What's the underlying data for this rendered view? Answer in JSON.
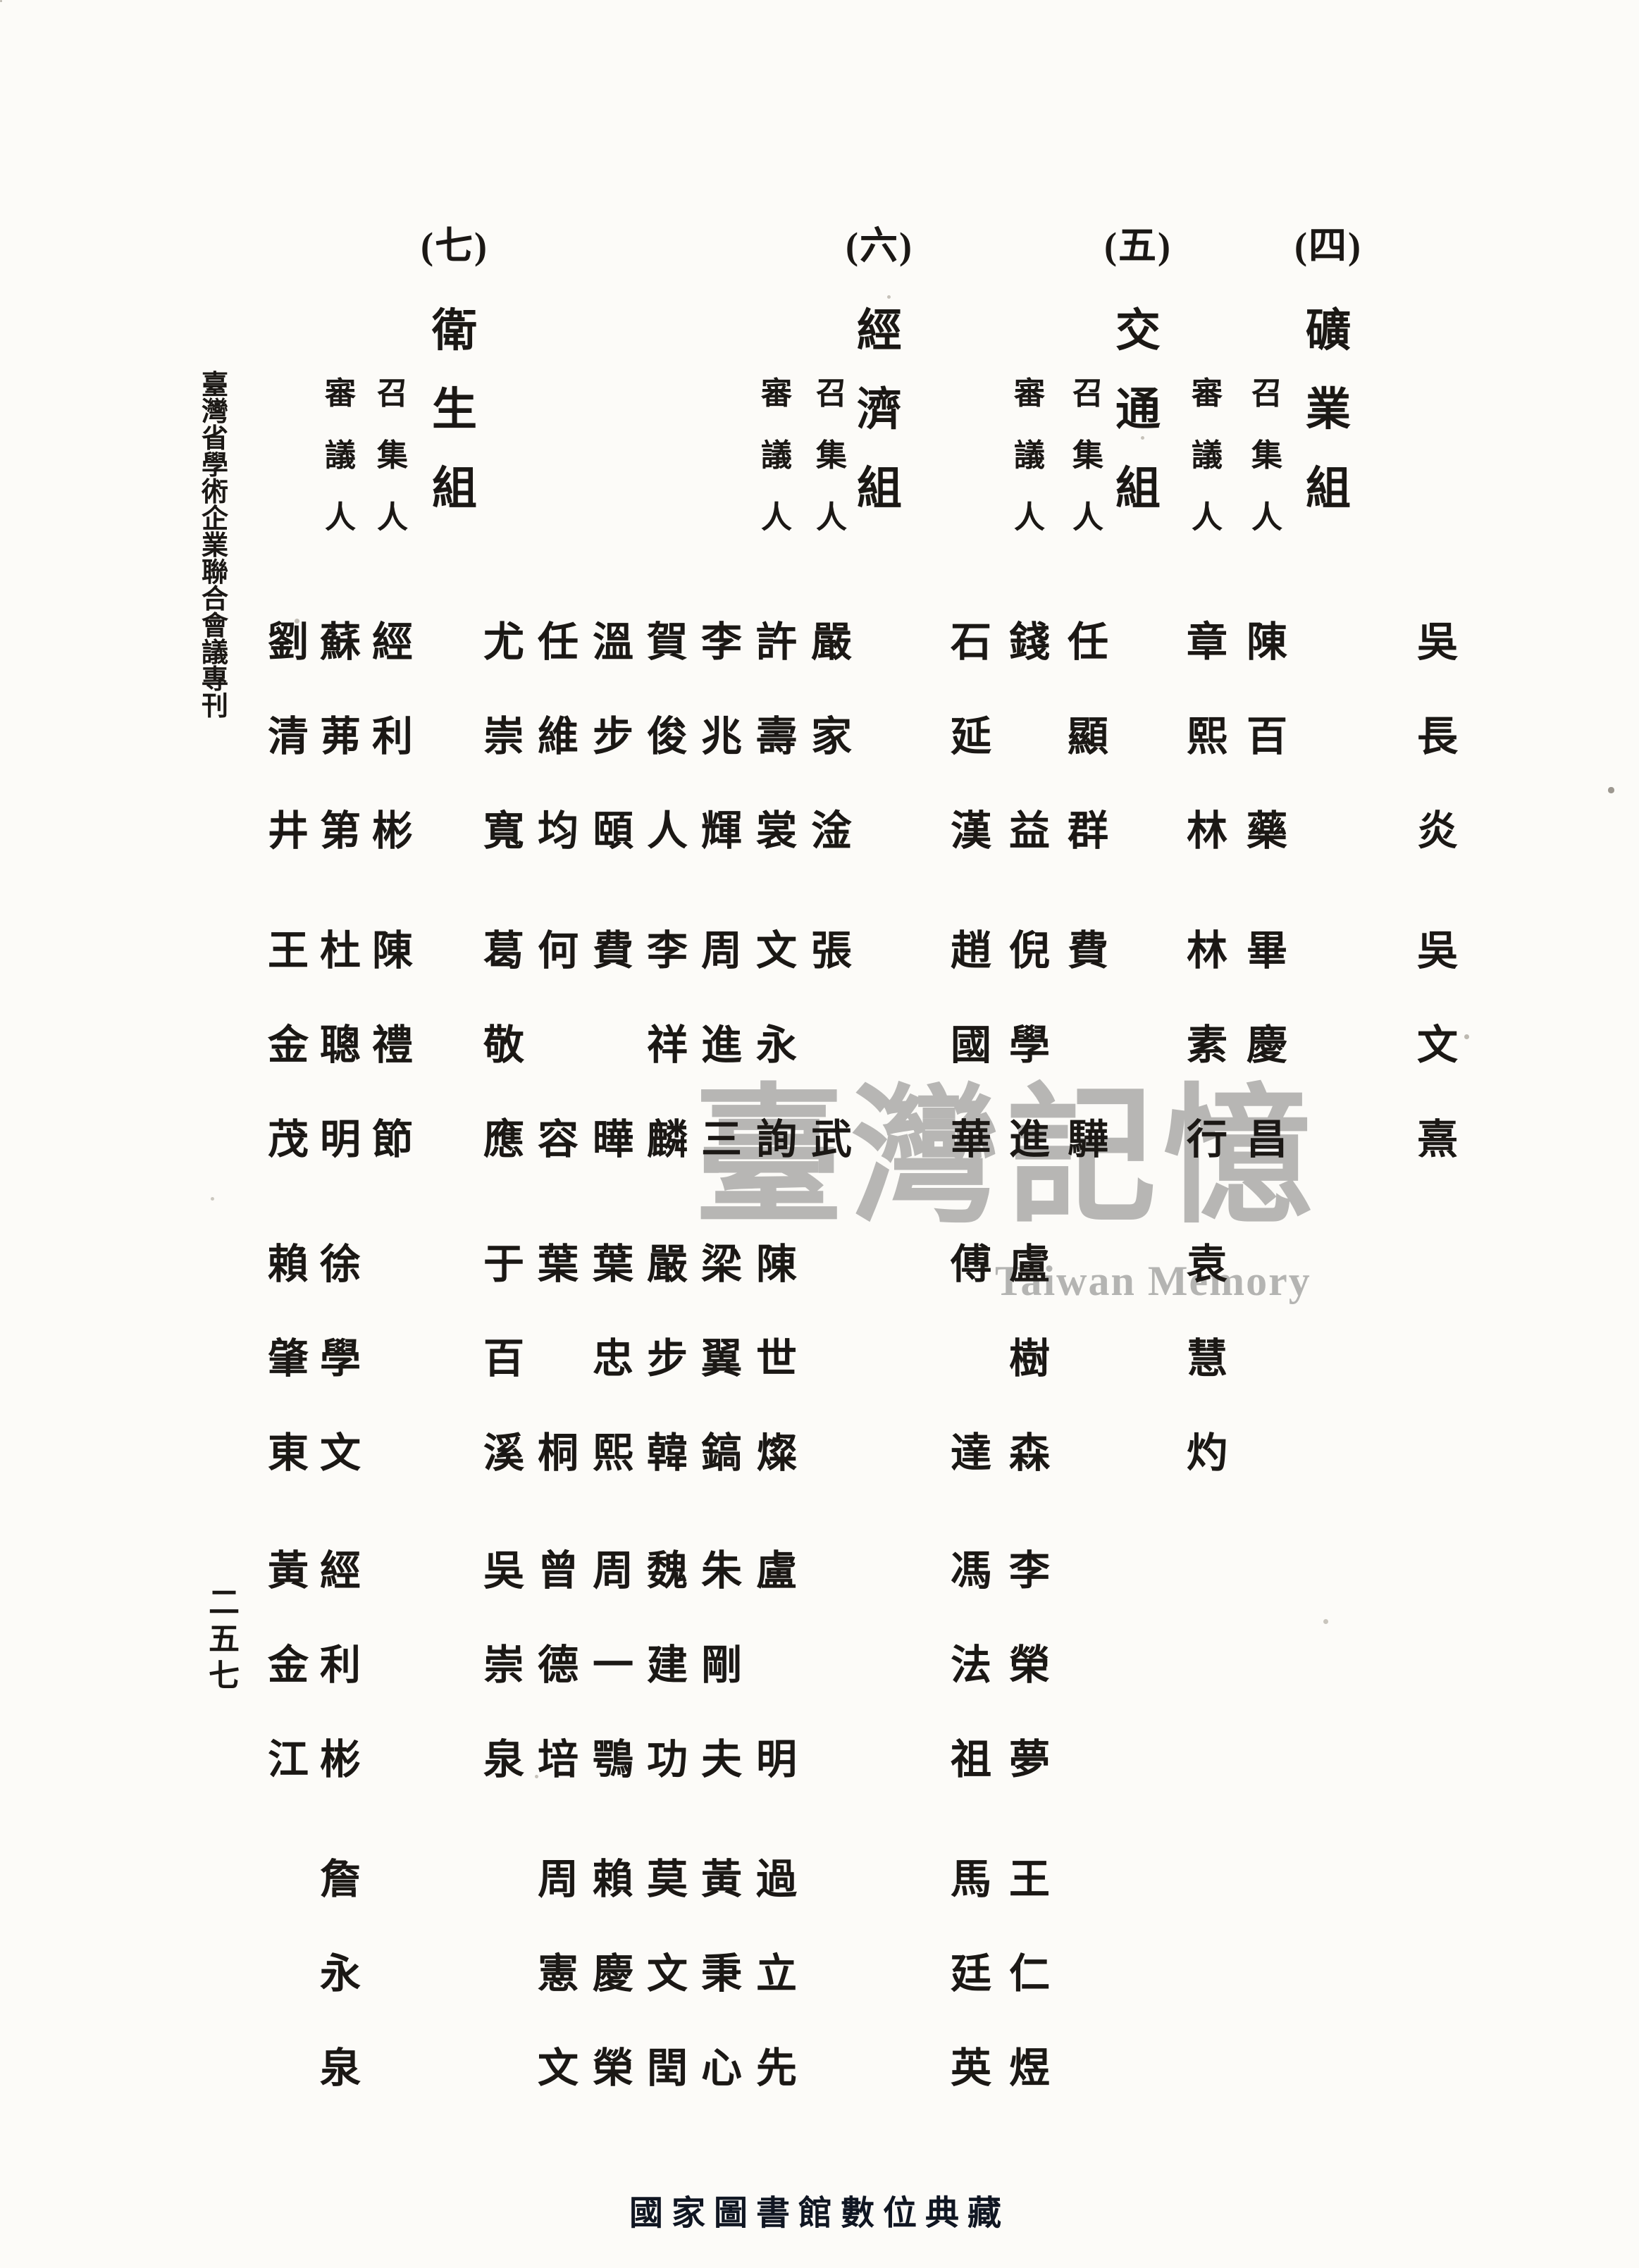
{
  "document": {
    "kind": "scanned-book-page",
    "paper_color": "#fcfbf8",
    "ink_color": "#1b1815",
    "spine_title": "臺灣省學術企業聯合會議專刊",
    "page_number": "二五七"
  },
  "watermark": {
    "cjk": "臺灣記憶",
    "latin": "Taiwan Memory",
    "color": "#a8a8a6"
  },
  "stamp": {
    "text": "國家圖書館數位典藏",
    "color": "#101622"
  },
  "carryover": {
    "note": "names continued from previous section, rightmost columns",
    "names": [
      {
        "t": "吳長炎",
        "g": 1
      },
      {
        "t": "吳文熹",
        "g": 2
      }
    ]
  },
  "sections": [
    {
      "id": "mining",
      "marker": "(四)",
      "title": "礦業組",
      "columns": [
        {
          "label": "召集人",
          "names": [
            {
              "t": "陳百藥",
              "g": 1
            },
            {
              "t": "畢慶昌",
              "g": 2
            }
          ]
        },
        {
          "label": "審議人",
          "names": [
            {
              "t": "章熙林",
              "g": 1
            },
            {
              "t": "林素行",
              "g": 2
            },
            {
              "t": "袁慧灼",
              "g": 3
            }
          ]
        }
      ]
    },
    {
      "id": "transportation",
      "marker": "(五)",
      "title": "交通組",
      "columns": [
        {
          "label": "召集人",
          "names": [
            {
              "t": "任顯群",
              "g": 1
            },
            {
              "t": "費驊",
              "g": 2,
              "spread": true
            }
          ]
        },
        {
          "label": "審議人",
          "names": [
            {
              "t": "錢益",
              "g": 1,
              "spread": true
            },
            {
              "t": "倪學進",
              "g": 2
            },
            {
              "t": "盧樹森",
              "g": 3
            },
            {
              "t": "李榮夢",
              "g": 4
            },
            {
              "t": "王仁煜",
              "g": 5
            }
          ]
        },
        {
          "label": "",
          "names": [
            {
              "t": "石延漢",
              "g": 1
            },
            {
              "t": "趙國華",
              "g": 2
            },
            {
              "t": "傅達",
              "g": 3,
              "spread": true
            },
            {
              "t": "馮法祖",
              "g": 4
            },
            {
              "t": "馬廷英",
              "g": 5
            }
          ]
        }
      ]
    },
    {
      "id": "economy",
      "marker": "(六)",
      "title": "經濟組",
      "columns": [
        {
          "label": "召集人",
          "names": [
            {
              "t": "嚴家淦",
              "g": 1
            },
            {
              "t": "張武",
              "g": 2,
              "spread": true
            }
          ]
        },
        {
          "label": "審議人",
          "names": [
            {
              "t": "許壽裳",
              "g": 1
            },
            {
              "t": "文永詢",
              "g": 2
            },
            {
              "t": "陳世燦",
              "g": 3
            },
            {
              "t": "盧明",
              "g": 4,
              "spread": true
            },
            {
              "t": "過立先",
              "g": 5
            }
          ]
        },
        {
          "label": "",
          "names": [
            {
              "t": "李兆輝",
              "g": 1
            },
            {
              "t": "周進三",
              "g": 2
            },
            {
              "t": "梁翼鎬",
              "g": 3
            },
            {
              "t": "朱剛夫",
              "g": 4
            },
            {
              "t": "黃秉心",
              "g": 5
            }
          ]
        },
        {
          "label": "",
          "names": [
            {
              "t": "賀俊人",
              "g": 1
            },
            {
              "t": "李祥麟",
              "g": 2
            },
            {
              "t": "嚴步韓",
              "g": 3
            },
            {
              "t": "魏建功",
              "g": 4
            },
            {
              "t": "莫文閏",
              "g": 5
            }
          ]
        },
        {
          "label": "",
          "names": [
            {
              "t": "溫步頤",
              "g": 1
            },
            {
              "t": "費曄",
              "g": 2,
              "spread": true
            },
            {
              "t": "葉忠熙",
              "g": 3
            },
            {
              "t": "周一鶚",
              "g": 4
            },
            {
              "t": "賴慶榮",
              "g": 5
            }
          ]
        },
        {
          "label": "",
          "names": [
            {
              "t": "任維均",
              "g": 1
            },
            {
              "t": "何容",
              "g": 2,
              "spread": true
            },
            {
              "t": "葉桐",
              "g": 3,
              "spread": true
            },
            {
              "t": "曾德培",
              "g": 4
            },
            {
              "t": "周憲文",
              "g": 5
            }
          ]
        },
        {
          "label": "",
          "names": [
            {
              "t": "尤崇寬",
              "g": 1
            },
            {
              "t": "葛敬應",
              "g": 2
            },
            {
              "t": "于百溪",
              "g": 3
            },
            {
              "t": "吳崇泉",
              "g": 4
            }
          ]
        }
      ]
    },
    {
      "id": "health",
      "marker": "(七)",
      "title": "衛生組",
      "columns": [
        {
          "label": "召集人",
          "names": [
            {
              "t": "經利彬",
              "g": 1
            },
            {
              "t": "陳禮節",
              "g": 2
            }
          ]
        },
        {
          "label": "審議人",
          "names": [
            {
              "t": "蘇茀第",
              "g": 1
            },
            {
              "t": "杜聰明",
              "g": 2
            },
            {
              "t": "徐學文",
              "g": 3
            },
            {
              "t": "經利彬",
              "g": 4
            },
            {
              "t": "詹永泉",
              "g": 5
            }
          ]
        },
        {
          "label": "",
          "names": [
            {
              "t": "劉清井",
              "g": 1
            },
            {
              "t": "王金茂",
              "g": 2
            },
            {
              "t": "賴肇東",
              "g": 3
            },
            {
              "t": "黃金江",
              "g": 4
            }
          ]
        }
      ]
    }
  ]
}
